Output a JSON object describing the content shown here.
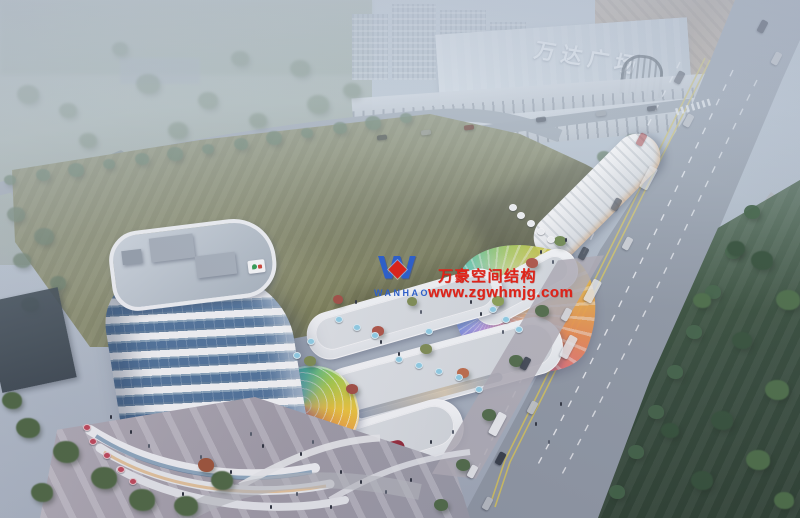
{
  "scene": {
    "description": "Aerial dusk rendering of a mixed-use commercial plaza with a banded white tower, terraced retail strips, rainbow glass dome and membrane canopy, beside a boulevard and Wanda Plaza mall",
    "signs": {
      "mall_sign": "万达广场"
    },
    "watermark": {
      "logo_letter": "W",
      "logo_text": "WANHAO",
      "title": "万豪空间结构",
      "url": "www.zgwhmjg.com",
      "text_color": "#e02318",
      "logo_color": "#2e5fc8",
      "diamond_color": "#d8241c"
    },
    "palette": {
      "haze": "#cdd9e4",
      "field_green": "#7d8054",
      "road_grey": "#8e97a3",
      "park_green": "#35503a",
      "tower_glass": "#4f749c",
      "tower_white": "#f8fafb",
      "dome_rainbow": [
        "#e8589a",
        "#a55ad0",
        "#5a7ae0",
        "#4ab8e8",
        "#48c8a8",
        "#a8d048",
        "#f0c838",
        "#f08848"
      ]
    }
  }
}
